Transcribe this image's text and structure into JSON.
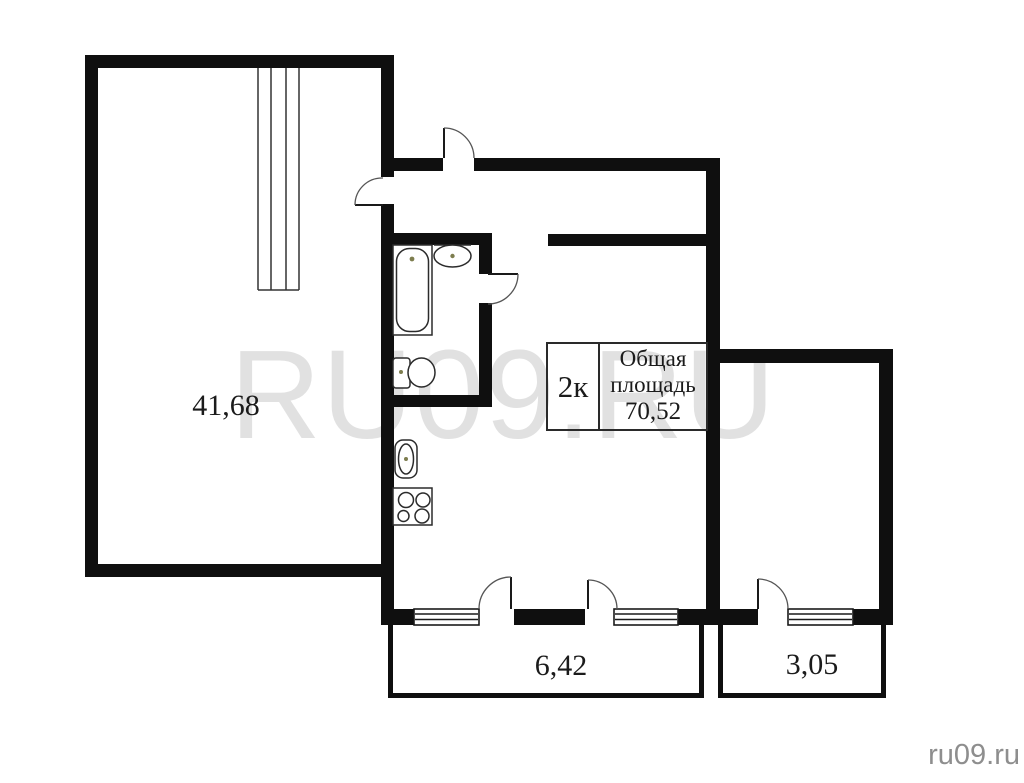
{
  "title_box": {
    "type": "2к",
    "label_lines": [
      "Общая",
      "площадь"
    ],
    "value": "70,52"
  },
  "areas": {
    "living": "41,68",
    "balcony_main": "6,42",
    "balcony_secondary": "3,05"
  },
  "watermarks": {
    "center": "RU09.RU",
    "corner": "ru09.ru"
  },
  "colors": {
    "wall": "#0f0f0f",
    "background": "#ffffff",
    "fixture_stroke": "#2b2b2b",
    "door_arc": "#555555",
    "watermark_center": "#e1e1e1",
    "watermark_corner": "#8e8e8e",
    "text": "#1b1b1b",
    "fixture_dot": "#7d7d4e"
  }
}
